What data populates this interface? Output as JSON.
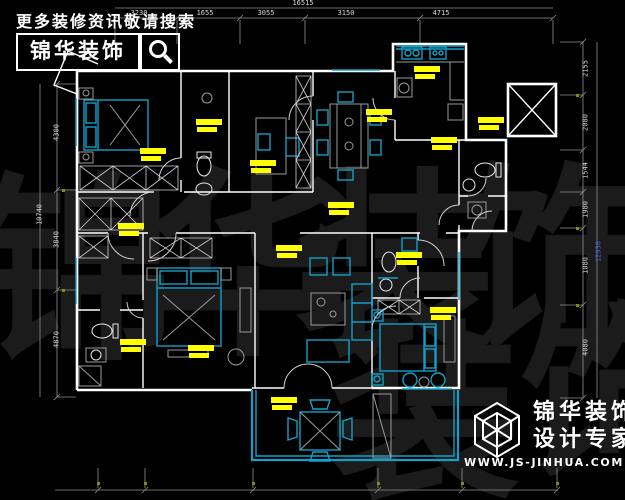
{
  "header": {
    "tagline": "更多装修资讯敬请搜索",
    "brand": "锦华装饰"
  },
  "watermark": {
    "char1": "锦",
    "char2": "华",
    "char3": "装",
    "char4": "饰"
  },
  "dimensions": {
    "top": {
      "total": "16515",
      "segments": [
        "3230",
        "1655",
        "3055",
        "3150",
        "4715"
      ]
    },
    "left": {
      "total": "10740",
      "segments": [
        "4300",
        "3840",
        "4870"
      ]
    },
    "right": {
      "total": "12930",
      "segments": [
        "2155",
        "2080",
        "1544",
        "1980",
        "1080",
        "4080"
      ]
    }
  },
  "footer": {
    "brand_line1": "锦华装饰",
    "brand_line2": "设计专家",
    "website": "WWW.JS-JINHUA.COM"
  },
  "colors": {
    "background": "#000000",
    "wall_white": "#ffffff",
    "accent_cyan": "#129fc9",
    "dim_gray": "#8f8f8f",
    "highlight_yellow": "#ffff00",
    "watermark_gray": "#1b1b1b",
    "total_blue": "#3f62e0"
  }
}
